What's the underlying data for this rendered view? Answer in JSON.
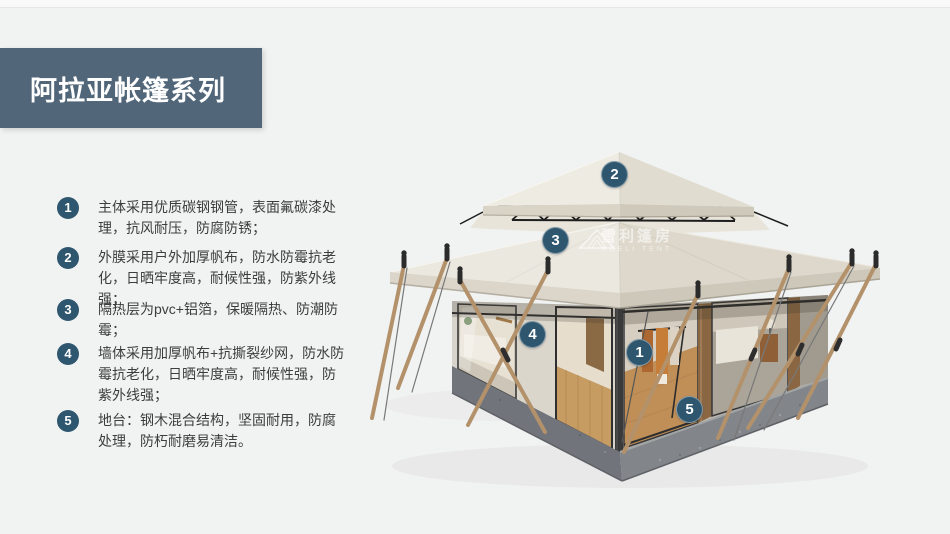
{
  "header": {
    "title": "阿拉亚帐篷系列"
  },
  "features": [
    {
      "num": "1",
      "text": "主体采用优质碳钢钢管，表面氟碳漆处理，抗风耐压，防腐防锈；"
    },
    {
      "num": "2",
      "text": "外膜采用户外加厚帆布，防水防霉抗老化，日晒牢度高，耐候性强，防紫外线强；"
    },
    {
      "num": "3",
      "text": "隔热层为pvc+铝箔，保暖隔热、防潮防霉；"
    },
    {
      "num": "4",
      "text": "墙体采用加厚帆布+抗撕裂纱网，防水防霉抗老化，日晒牢度高，耐候性强，防紫外线强；"
    },
    {
      "num": "5",
      "text": "地台：钢木混合结构，坚固耐用，防腐处理，防朽耐磨易清洁。"
    }
  ],
  "image_markers": [
    {
      "num": "1"
    },
    {
      "num": "2"
    },
    {
      "num": "3"
    },
    {
      "num": "4"
    },
    {
      "num": "5"
    }
  ],
  "watermark": {
    "cn": "雪利篷房",
    "en": "XUELI TENT"
  },
  "colors": {
    "band": "#516779",
    "badge": "#2e566e",
    "roof": "#ebe8e0",
    "background": "#f1f2f2"
  }
}
